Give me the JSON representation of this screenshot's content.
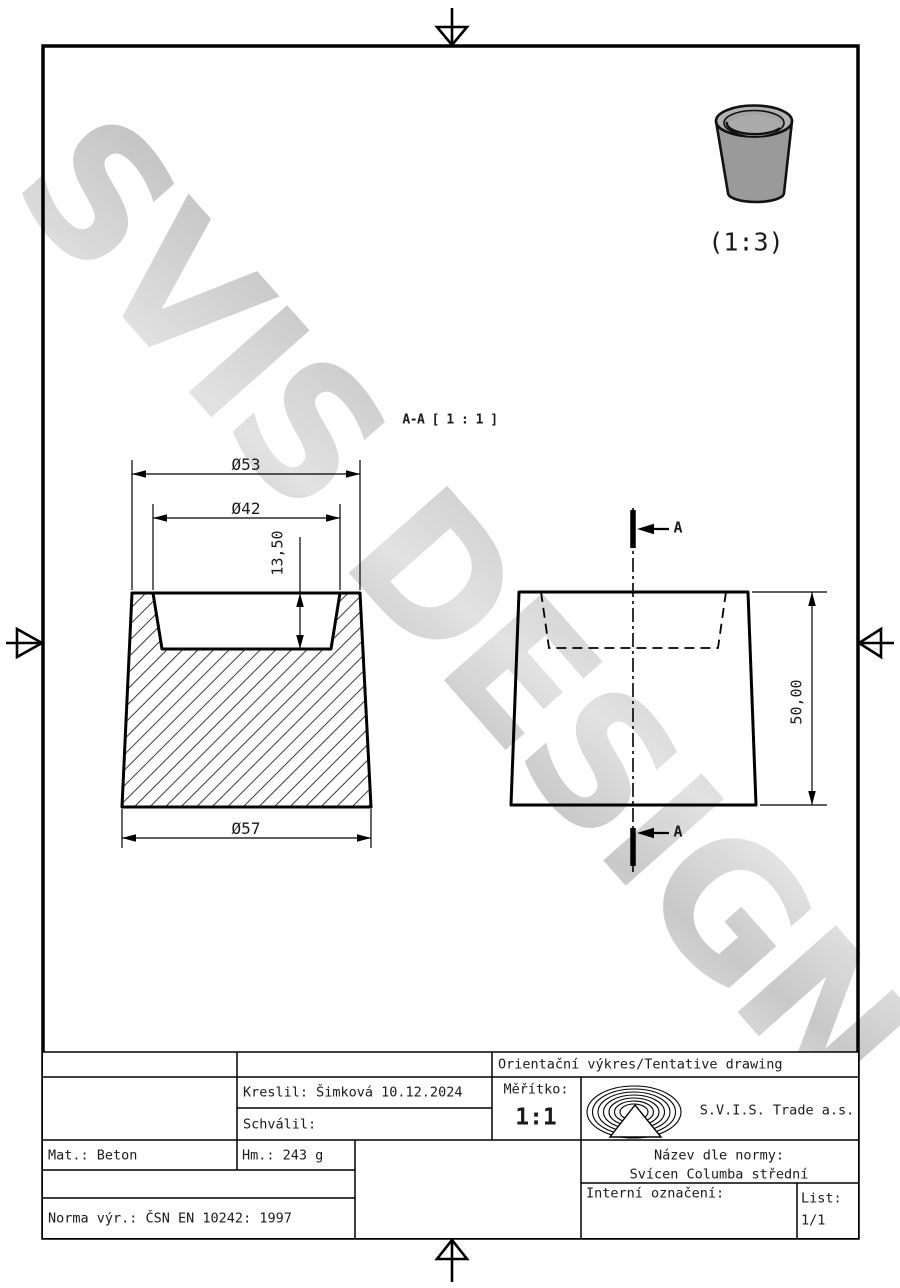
{
  "watermark": {
    "text": "SVIS DESIGN"
  },
  "preview": {
    "scale": "(1:3)"
  },
  "section_view": {
    "label": "A-A [ 1 : 1 ]",
    "dia_top": "Ø53",
    "dia_inner": "Ø42",
    "depth": "13,50",
    "dia_bottom": "Ø57"
  },
  "side_view": {
    "height": "50,00",
    "cut_label_top": "A",
    "cut_label_bottom": "A"
  },
  "title_block": {
    "tentative": "Orientační výkres/Tentative drawing",
    "kreslil": "Kreslil: Šimková 10.12.2024",
    "schvalil": "Schválil:",
    "meritko_label": "Měřítko:",
    "meritko_value": "1:1",
    "company": "S.V.I.S. Trade a.s.",
    "mat": "Mat.: Beton",
    "hm": "Hm.: 243 g",
    "nazev_label": "Název dle normy:",
    "nazev_value": "Svícen Columba střední",
    "interni": "Interní označení:",
    "list_label": "List:",
    "list_value": "1/1",
    "norma": "Norma výr.: ČSN EN 10242: 1997"
  },
  "colors": {
    "line": "#000000",
    "watermark_gray": "#cccccc",
    "body_gray": "#9a9a9a"
  }
}
